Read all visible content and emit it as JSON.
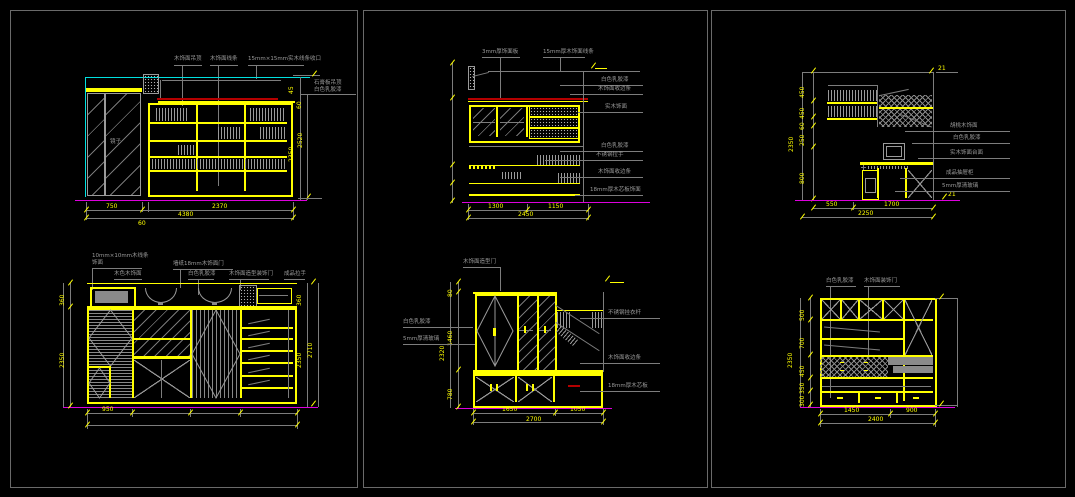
{
  "drawing": {
    "background": "#000000",
    "line_colors": {
      "structure": "#ffff00",
      "ceiling": "#00e0e0",
      "floor": "#dd00dd",
      "accent": "#b40000",
      "annotation": "#9a9a9a"
    }
  },
  "p1": {
    "top_labels": [
      "木饰面吊顶",
      "木饰面线条",
      "15mm×15mm实木线条收口"
    ],
    "side_note_line1": "石膏板吊顶",
    "side_note_line2": "白色乳胶漆",
    "door_label": "镜子",
    "vdim_1": "45",
    "vdim_2": "60",
    "vdim_3": "2520",
    "vdim_4": "2350",
    "dim_1": "750",
    "dim_2": "60",
    "dim_3": "2370",
    "dim_total": "4380"
  },
  "p2": {
    "top_labels": [
      "3mm厚饰面板",
      "15mm厚木饰面线条"
    ],
    "right_labels": [
      "白色乳胶漆",
      "木饰面收边条",
      "实木饰面",
      "白色乳胶漆",
      "不锈钢拉手",
      "木饰面收边条",
      "18mm厚木芯板饰面"
    ],
    "dim_1": "1300",
    "dim_2": "1150",
    "dim_total": "2450"
  },
  "p3": {
    "left_dims": [
      "450",
      "450",
      "60",
      "250",
      "800"
    ],
    "left_total": "2350",
    "right_labels": [
      "胡桃木饰面",
      "白色乳胶漆",
      "实木饰面台面",
      "成品抽屉柜",
      "5mm厚清玻璃"
    ],
    "dim_1": "550",
    "dim_2": "1700",
    "dim_total": "2250",
    "mark_top": "21",
    "mark_bottom": "21"
  },
  "p4": {
    "top_label1a": "10mm×10mm木线条",
    "top_label1b": "饰面",
    "top_label2": "墙纸18mm木饰面门",
    "row_labels": [
      "木色木饰面",
      "白色乳胶漆",
      "木饰面造型装饰门",
      "成品拉手"
    ],
    "left_dim_1": "360",
    "left_dim_2": "2350",
    "right_dim_1": "360",
    "right_dim_2": "2350",
    "right_total": "2710",
    "dim_1": "950"
  },
  "p5": {
    "top_label": "木饰面造型门",
    "left_labels": [
      "白色乳胶漆",
      "5mm厚清玻璃"
    ],
    "right_labels": [
      "不锈钢挂衣杆",
      "木饰面收边条",
      "18mm厚木芯板"
    ],
    "left_dim_1": "80",
    "left_dim_2": "1460",
    "left_dim_3": "780",
    "left_total": "2320",
    "dim_1": "1650",
    "dim_2": "1050",
    "dim_total": "2700"
  },
  "p6": {
    "top_labels": [
      "白色乳胶漆",
      "木饰面装饰门"
    ],
    "left_dims": [
      "500",
      "700",
      "450",
      "350",
      "300"
    ],
    "left_total": "2350",
    "dim_1": "1450",
    "dim_2": "900",
    "dim_total": "2400"
  }
}
